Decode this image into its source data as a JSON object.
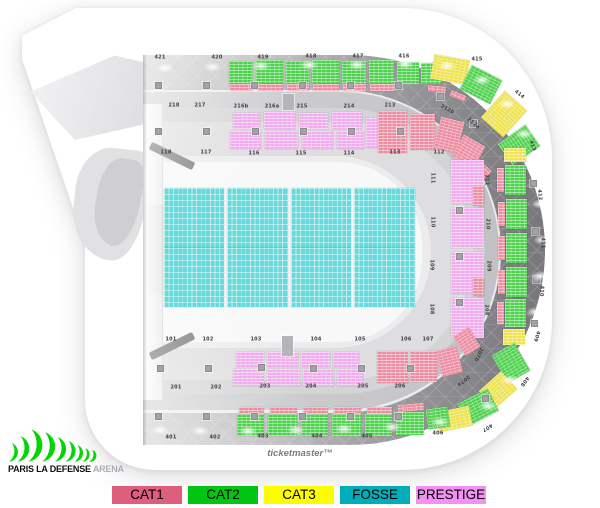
{
  "brand": {
    "bold": "PARIS LA DEFENSE",
    "light": "ARENA"
  },
  "watermark": "ticketmaster™",
  "legend": [
    {
      "label": "CAT1",
      "color": "#dd5f7d"
    },
    {
      "label": "CAT2",
      "color": "#00c613"
    },
    {
      "label": "CAT3",
      "color": "#fdfd00"
    },
    {
      "label": "FOSSE",
      "color": "#00adb8"
    },
    {
      "label": "PRESTIGE",
      "color": "#f391f3"
    }
  ],
  "map": {
    "category_colors": {
      "cat1": "#ec8da1",
      "cat2": "#4fd14f",
      "cat3": "#eee24f",
      "fosse": "#68dadc",
      "prestige": "#f1abef"
    },
    "floor": [
      {
        "x": 164,
        "y": 188,
        "w": 60,
        "h": 119
      },
      {
        "x": 227,
        "y": 188,
        "w": 61,
        "h": 119
      },
      {
        "x": 291,
        "y": 188,
        "w": 60,
        "h": 119
      },
      {
        "x": 354,
        "y": 188,
        "w": 61,
        "h": 119
      }
    ],
    "blocks": [
      {
        "c": "cat2",
        "x": 229,
        "y": 61,
        "w": 24,
        "h": 23
      },
      {
        "c": "cat2",
        "x": 256,
        "y": 60,
        "w": 27,
        "h": 24
      },
      {
        "c": "cat2",
        "x": 286,
        "y": 61,
        "w": 23,
        "h": 23
      },
      {
        "c": "cat2",
        "x": 312,
        "y": 60,
        "w": 27,
        "h": 24
      },
      {
        "c": "cat2",
        "x": 342,
        "y": 61,
        "w": 24,
        "h": 23
      },
      {
        "c": "cat2",
        "x": 369,
        "y": 60,
        "w": 25,
        "h": 24
      },
      {
        "c": "cat2",
        "x": 397,
        "y": 62,
        "w": 22,
        "h": 22
      },
      {
        "c": "cat2",
        "x": 421,
        "y": 63,
        "w": 20,
        "h": 21
      },
      {
        "c": "cat1",
        "x": 230,
        "y": 84,
        "w": 23,
        "h": 7
      },
      {
        "c": "cat1",
        "x": 257,
        "y": 84,
        "w": 26,
        "h": 7
      },
      {
        "c": "cat1",
        "x": 287,
        "y": 84,
        "w": 22,
        "h": 7
      },
      {
        "c": "cat1",
        "x": 313,
        "y": 84,
        "w": 26,
        "h": 7
      },
      {
        "c": "cat1",
        "x": 343,
        "y": 84,
        "w": 23,
        "h": 7
      },
      {
        "c": "cat1",
        "x": 370,
        "y": 84,
        "w": 24,
        "h": 7
      },
      {
        "c": "cat3",
        "x": 432,
        "y": 57,
        "w": 36,
        "h": 25,
        "r": 10
      },
      {
        "c": "cat2",
        "x": 464,
        "y": 71,
        "w": 34,
        "h": 27,
        "r": 27
      },
      {
        "c": "cat3",
        "x": 489,
        "y": 96,
        "w": 30,
        "h": 36,
        "r": 42
      },
      {
        "c": "cat2",
        "x": 506,
        "y": 128,
        "w": 26,
        "h": 34,
        "r": 55
      },
      {
        "c": "cat1",
        "x": 428,
        "y": 86,
        "w": 18,
        "h": 6,
        "r": 5
      },
      {
        "c": "cat1",
        "x": 450,
        "y": 93,
        "w": 16,
        "h": 6,
        "r": 22
      },
      {
        "c": "cat3",
        "x": 504,
        "y": 148,
        "w": 22,
        "h": 14
      },
      {
        "c": "cat2",
        "x": 505,
        "y": 165,
        "w": 21,
        "h": 30
      },
      {
        "c": "cat2",
        "x": 506,
        "y": 199,
        "w": 21,
        "h": 30
      },
      {
        "c": "cat2",
        "x": 506,
        "y": 233,
        "w": 21,
        "h": 30
      },
      {
        "c": "cat2",
        "x": 506,
        "y": 267,
        "w": 21,
        "h": 30
      },
      {
        "c": "cat2",
        "x": 505,
        "y": 299,
        "w": 21,
        "h": 28
      },
      {
        "c": "cat3",
        "x": 503,
        "y": 329,
        "w": 22,
        "h": 16
      },
      {
        "c": "cat1",
        "x": 497,
        "y": 168,
        "w": 7,
        "h": 24
      },
      {
        "c": "cat1",
        "x": 498,
        "y": 202,
        "w": 7,
        "h": 24
      },
      {
        "c": "cat1",
        "x": 498,
        "y": 236,
        "w": 7,
        "h": 24
      },
      {
        "c": "cat1",
        "x": 498,
        "y": 270,
        "w": 7,
        "h": 24
      },
      {
        "c": "cat1",
        "x": 497,
        "y": 302,
        "w": 7,
        "h": 22
      },
      {
        "c": "cat2",
        "x": 498,
        "y": 347,
        "w": 26,
        "h": 32,
        "r": -30
      },
      {
        "c": "cat3",
        "x": 483,
        "y": 378,
        "w": 30,
        "h": 24,
        "r": -42
      },
      {
        "c": "cat2",
        "x": 461,
        "y": 395,
        "w": 34,
        "h": 25,
        "r": -27
      },
      {
        "c": "cat3",
        "x": 437,
        "y": 409,
        "w": 34,
        "h": 20,
        "r": -12
      },
      {
        "c": "cat2",
        "x": 237,
        "y": 414,
        "w": 27,
        "h": 22
      },
      {
        "c": "cat2",
        "x": 268,
        "y": 414,
        "w": 29,
        "h": 22
      },
      {
        "c": "cat2",
        "x": 301,
        "y": 414,
        "w": 27,
        "h": 22
      },
      {
        "c": "cat2",
        "x": 332,
        "y": 414,
        "w": 29,
        "h": 22
      },
      {
        "c": "cat2",
        "x": 365,
        "y": 414,
        "w": 27,
        "h": 22
      },
      {
        "c": "cat2",
        "x": 396,
        "y": 412,
        "w": 28,
        "h": 23
      },
      {
        "c": "cat2",
        "x": 427,
        "y": 408,
        "w": 22,
        "h": 20,
        "r": -8
      },
      {
        "c": "cat1",
        "x": 239,
        "y": 407,
        "w": 25,
        "h": 7
      },
      {
        "c": "cat1",
        "x": 270,
        "y": 407,
        "w": 27,
        "h": 7
      },
      {
        "c": "cat1",
        "x": 303,
        "y": 407,
        "w": 25,
        "h": 7
      },
      {
        "c": "cat1",
        "x": 334,
        "y": 407,
        "w": 27,
        "h": 7
      },
      {
        "c": "cat1",
        "x": 367,
        "y": 407,
        "w": 25,
        "h": 7
      },
      {
        "c": "cat1",
        "x": 398,
        "y": 404,
        "w": 26,
        "h": 7,
        "r": -5
      },
      {
        "c": "prestige",
        "x": 233,
        "y": 113,
        "w": 27,
        "h": 16
      },
      {
        "c": "prestige",
        "x": 264,
        "y": 112,
        "w": 31,
        "h": 17
      },
      {
        "c": "prestige",
        "x": 299,
        "y": 113,
        "w": 29,
        "h": 16
      },
      {
        "c": "prestige",
        "x": 332,
        "y": 112,
        "w": 30,
        "h": 17
      },
      {
        "c": "prestige",
        "x": 230,
        "y": 131,
        "w": 31,
        "h": 18
      },
      {
        "c": "prestige",
        "x": 265,
        "y": 131,
        "w": 33,
        "h": 18
      },
      {
        "c": "prestige",
        "x": 302,
        "y": 131,
        "w": 31,
        "h": 18
      },
      {
        "c": "prestige",
        "x": 337,
        "y": 131,
        "w": 27,
        "h": 18
      },
      {
        "c": "prestige",
        "x": 366,
        "y": 118,
        "w": 12,
        "h": 30
      },
      {
        "c": "cat1",
        "x": 378,
        "y": 111,
        "w": 29,
        "h": 42
      },
      {
        "c": "cat1",
        "x": 410,
        "y": 114,
        "w": 25,
        "h": 36
      },
      {
        "c": "cat1",
        "x": 437,
        "y": 119,
        "w": 24,
        "h": 32,
        "r": 14
      },
      {
        "c": "cat1",
        "x": 456,
        "y": 139,
        "w": 25,
        "h": 25,
        "r": 30
      },
      {
        "c": "cat1",
        "x": 466,
        "y": 161,
        "w": 20,
        "h": 25,
        "r": 44
      },
      {
        "c": "prestige",
        "x": 451,
        "y": 160,
        "w": 33,
        "h": 44
      },
      {
        "c": "prestige",
        "x": 451,
        "y": 208,
        "w": 33,
        "h": 40
      },
      {
        "c": "prestige",
        "x": 451,
        "y": 252,
        "w": 33,
        "h": 42
      },
      {
        "c": "prestige",
        "x": 451,
        "y": 298,
        "w": 33,
        "h": 40
      },
      {
        "c": "cat1",
        "x": 473,
        "y": 186,
        "w": 11,
        "h": 20
      },
      {
        "c": "cat1",
        "x": 473,
        "y": 278,
        "w": 11,
        "h": 18
      },
      {
        "c": "cat1",
        "x": 377,
        "y": 351,
        "w": 31,
        "h": 32
      },
      {
        "c": "cat1",
        "x": 410,
        "y": 351,
        "w": 27,
        "h": 31
      },
      {
        "c": "cat1",
        "x": 439,
        "y": 348,
        "w": 21,
        "h": 27,
        "r": -14
      },
      {
        "c": "cat1",
        "x": 458,
        "y": 330,
        "w": 18,
        "h": 23,
        "r": -32
      },
      {
        "c": "prestige",
        "x": 236,
        "y": 352,
        "w": 28,
        "h": 15
      },
      {
        "c": "prestige",
        "x": 267,
        "y": 352,
        "w": 31,
        "h": 15
      },
      {
        "c": "prestige",
        "x": 301,
        "y": 352,
        "w": 29,
        "h": 15
      },
      {
        "c": "prestige",
        "x": 333,
        "y": 352,
        "w": 26,
        "h": 15
      },
      {
        "c": "prestige",
        "x": 233,
        "y": 369,
        "w": 31,
        "h": 17
      },
      {
        "c": "prestige",
        "x": 267,
        "y": 369,
        "w": 33,
        "h": 17
      },
      {
        "c": "prestige",
        "x": 303,
        "y": 369,
        "w": 31,
        "h": 17
      },
      {
        "c": "prestige",
        "x": 337,
        "y": 369,
        "w": 26,
        "h": 17
      }
    ],
    "labels": [
      {
        "t": "421",
        "x": 160,
        "y": 58
      },
      {
        "t": "420",
        "x": 217,
        "y": 58
      },
      {
        "t": "419",
        "x": 263,
        "y": 58
      },
      {
        "t": "418",
        "x": 311,
        "y": 57
      },
      {
        "t": "417",
        "x": 358,
        "y": 57
      },
      {
        "t": "416",
        "x": 404,
        "y": 57
      },
      {
        "t": "415",
        "x": 477,
        "y": 60
      },
      {
        "t": "414",
        "x": 519,
        "y": 95,
        "r": 38
      },
      {
        "t": "413",
        "x": 532,
        "y": 146,
        "r": 70
      },
      {
        "t": "412",
        "x": 539,
        "y": 195,
        "r": 85
      },
      {
        "t": "411",
        "x": 542,
        "y": 243,
        "r": 90
      },
      {
        "t": "410",
        "x": 541,
        "y": 291,
        "r": 95
      },
      {
        "t": "409",
        "x": 536,
        "y": 336,
        "r": 108
      },
      {
        "t": "408",
        "x": 524,
        "y": 381,
        "r": 126
      },
      {
        "t": "407",
        "x": 487,
        "y": 427,
        "r": 148
      },
      {
        "t": "406",
        "x": 438,
        "y": 434
      },
      {
        "t": "405",
        "x": 367,
        "y": 437
      },
      {
        "t": "404",
        "x": 317,
        "y": 437
      },
      {
        "t": "403",
        "x": 263,
        "y": 437
      },
      {
        "t": "402",
        "x": 215,
        "y": 438
      },
      {
        "t": "401",
        "x": 171,
        "y": 438
      },
      {
        "t": "218",
        "x": 174,
        "y": 106
      },
      {
        "t": "217",
        "x": 200,
        "y": 106
      },
      {
        "t": "216b",
        "x": 241,
        "y": 107
      },
      {
        "t": "216a",
        "x": 272,
        "y": 107
      },
      {
        "t": "215",
        "x": 302,
        "y": 107
      },
      {
        "t": "214",
        "x": 349,
        "y": 107
      },
      {
        "t": "213",
        "x": 390,
        "y": 106
      },
      {
        "t": "212b",
        "x": 447,
        "y": 110,
        "r": 28
      },
      {
        "t": "212a",
        "x": 473,
        "y": 124,
        "r": 40
      },
      {
        "t": "211",
        "x": 486,
        "y": 180,
        "r": 90
      },
      {
        "t": "210",
        "x": 487,
        "y": 224,
        "r": 90
      },
      {
        "t": "209",
        "x": 488,
        "y": 266,
        "r": 90
      },
      {
        "t": "208",
        "x": 486,
        "y": 310,
        "r": 90
      },
      {
        "t": "207b",
        "x": 478,
        "y": 354,
        "r": 115
      },
      {
        "t": "207a",
        "x": 463,
        "y": 380,
        "r": 140
      },
      {
        "t": "206",
        "x": 400,
        "y": 387
      },
      {
        "t": "205",
        "x": 363,
        "y": 387
      },
      {
        "t": "204",
        "x": 311,
        "y": 387
      },
      {
        "t": "203",
        "x": 265,
        "y": 387
      },
      {
        "t": "202",
        "x": 216,
        "y": 388
      },
      {
        "t": "201",
        "x": 176,
        "y": 388
      },
      {
        "t": "118",
        "x": 166,
        "y": 153
      },
      {
        "t": "117",
        "x": 206,
        "y": 153
      },
      {
        "t": "116",
        "x": 254,
        "y": 154
      },
      {
        "t": "115",
        "x": 301,
        "y": 154
      },
      {
        "t": "114",
        "x": 349,
        "y": 154
      },
      {
        "t": "113",
        "x": 395,
        "y": 153
      },
      {
        "t": "112",
        "x": 439,
        "y": 153
      },
      {
        "t": "111",
        "x": 432,
        "y": 178,
        "r": 90
      },
      {
        "t": "110",
        "x": 432,
        "y": 222,
        "r": 90
      },
      {
        "t": "109",
        "x": 431,
        "y": 265,
        "r": 90
      },
      {
        "t": "108",
        "x": 431,
        "y": 309,
        "r": 90
      },
      {
        "t": "107",
        "x": 428,
        "y": 340
      },
      {
        "t": "106",
        "x": 406,
        "y": 340
      },
      {
        "t": "105",
        "x": 360,
        "y": 340
      },
      {
        "t": "104",
        "x": 316,
        "y": 340
      },
      {
        "t": "103",
        "x": 256,
        "y": 340
      },
      {
        "t": "102",
        "x": 208,
        "y": 340
      },
      {
        "t": "101",
        "x": 171,
        "y": 340
      }
    ],
    "lamps": [
      [
        165,
        68
      ],
      [
        213,
        67
      ],
      [
        261,
        66
      ],
      [
        309,
        65
      ],
      [
        357,
        65
      ],
      [
        405,
        64
      ],
      [
        447,
        66
      ],
      [
        482,
        80
      ],
      [
        507,
        104
      ],
      [
        524,
        134
      ],
      [
        535,
        168
      ],
      [
        540,
        204
      ],
      [
        542,
        240
      ],
      [
        540,
        276
      ],
      [
        535,
        312
      ],
      [
        525,
        348
      ],
      [
        510,
        380
      ],
      [
        488,
        406
      ],
      [
        440,
        422
      ],
      [
        392,
        427
      ],
      [
        344,
        429
      ],
      [
        296,
        430
      ],
      [
        248,
        431
      ],
      [
        200,
        431
      ],
      [
        160,
        430
      ]
    ],
    "pillars": [
      [
        155,
        82
      ],
      [
        203,
        82
      ],
      [
        251,
        82
      ],
      [
        299,
        82
      ],
      [
        347,
        82
      ],
      [
        395,
        82
      ],
      [
        155,
        128
      ],
      [
        203,
        128
      ],
      [
        252,
        128
      ],
      [
        300,
        128
      ],
      [
        348,
        128
      ],
      [
        397,
        128
      ],
      [
        157,
        365
      ],
      [
        205,
        365
      ],
      [
        258,
        364
      ],
      [
        310,
        365
      ],
      [
        358,
        365
      ],
      [
        407,
        365
      ],
      [
        155,
        413
      ],
      [
        203,
        413
      ],
      [
        251,
        413
      ],
      [
        299,
        413
      ],
      [
        347,
        413
      ],
      [
        395,
        413
      ],
      [
        456,
        207
      ],
      [
        456,
        253
      ],
      [
        456,
        299
      ],
      [
        530,
        180
      ],
      [
        532,
        228
      ],
      [
        533,
        276
      ],
      [
        531,
        320
      ],
      [
        437,
        93
      ],
      [
        470,
        120
      ],
      [
        482,
        395
      ]
    ]
  }
}
